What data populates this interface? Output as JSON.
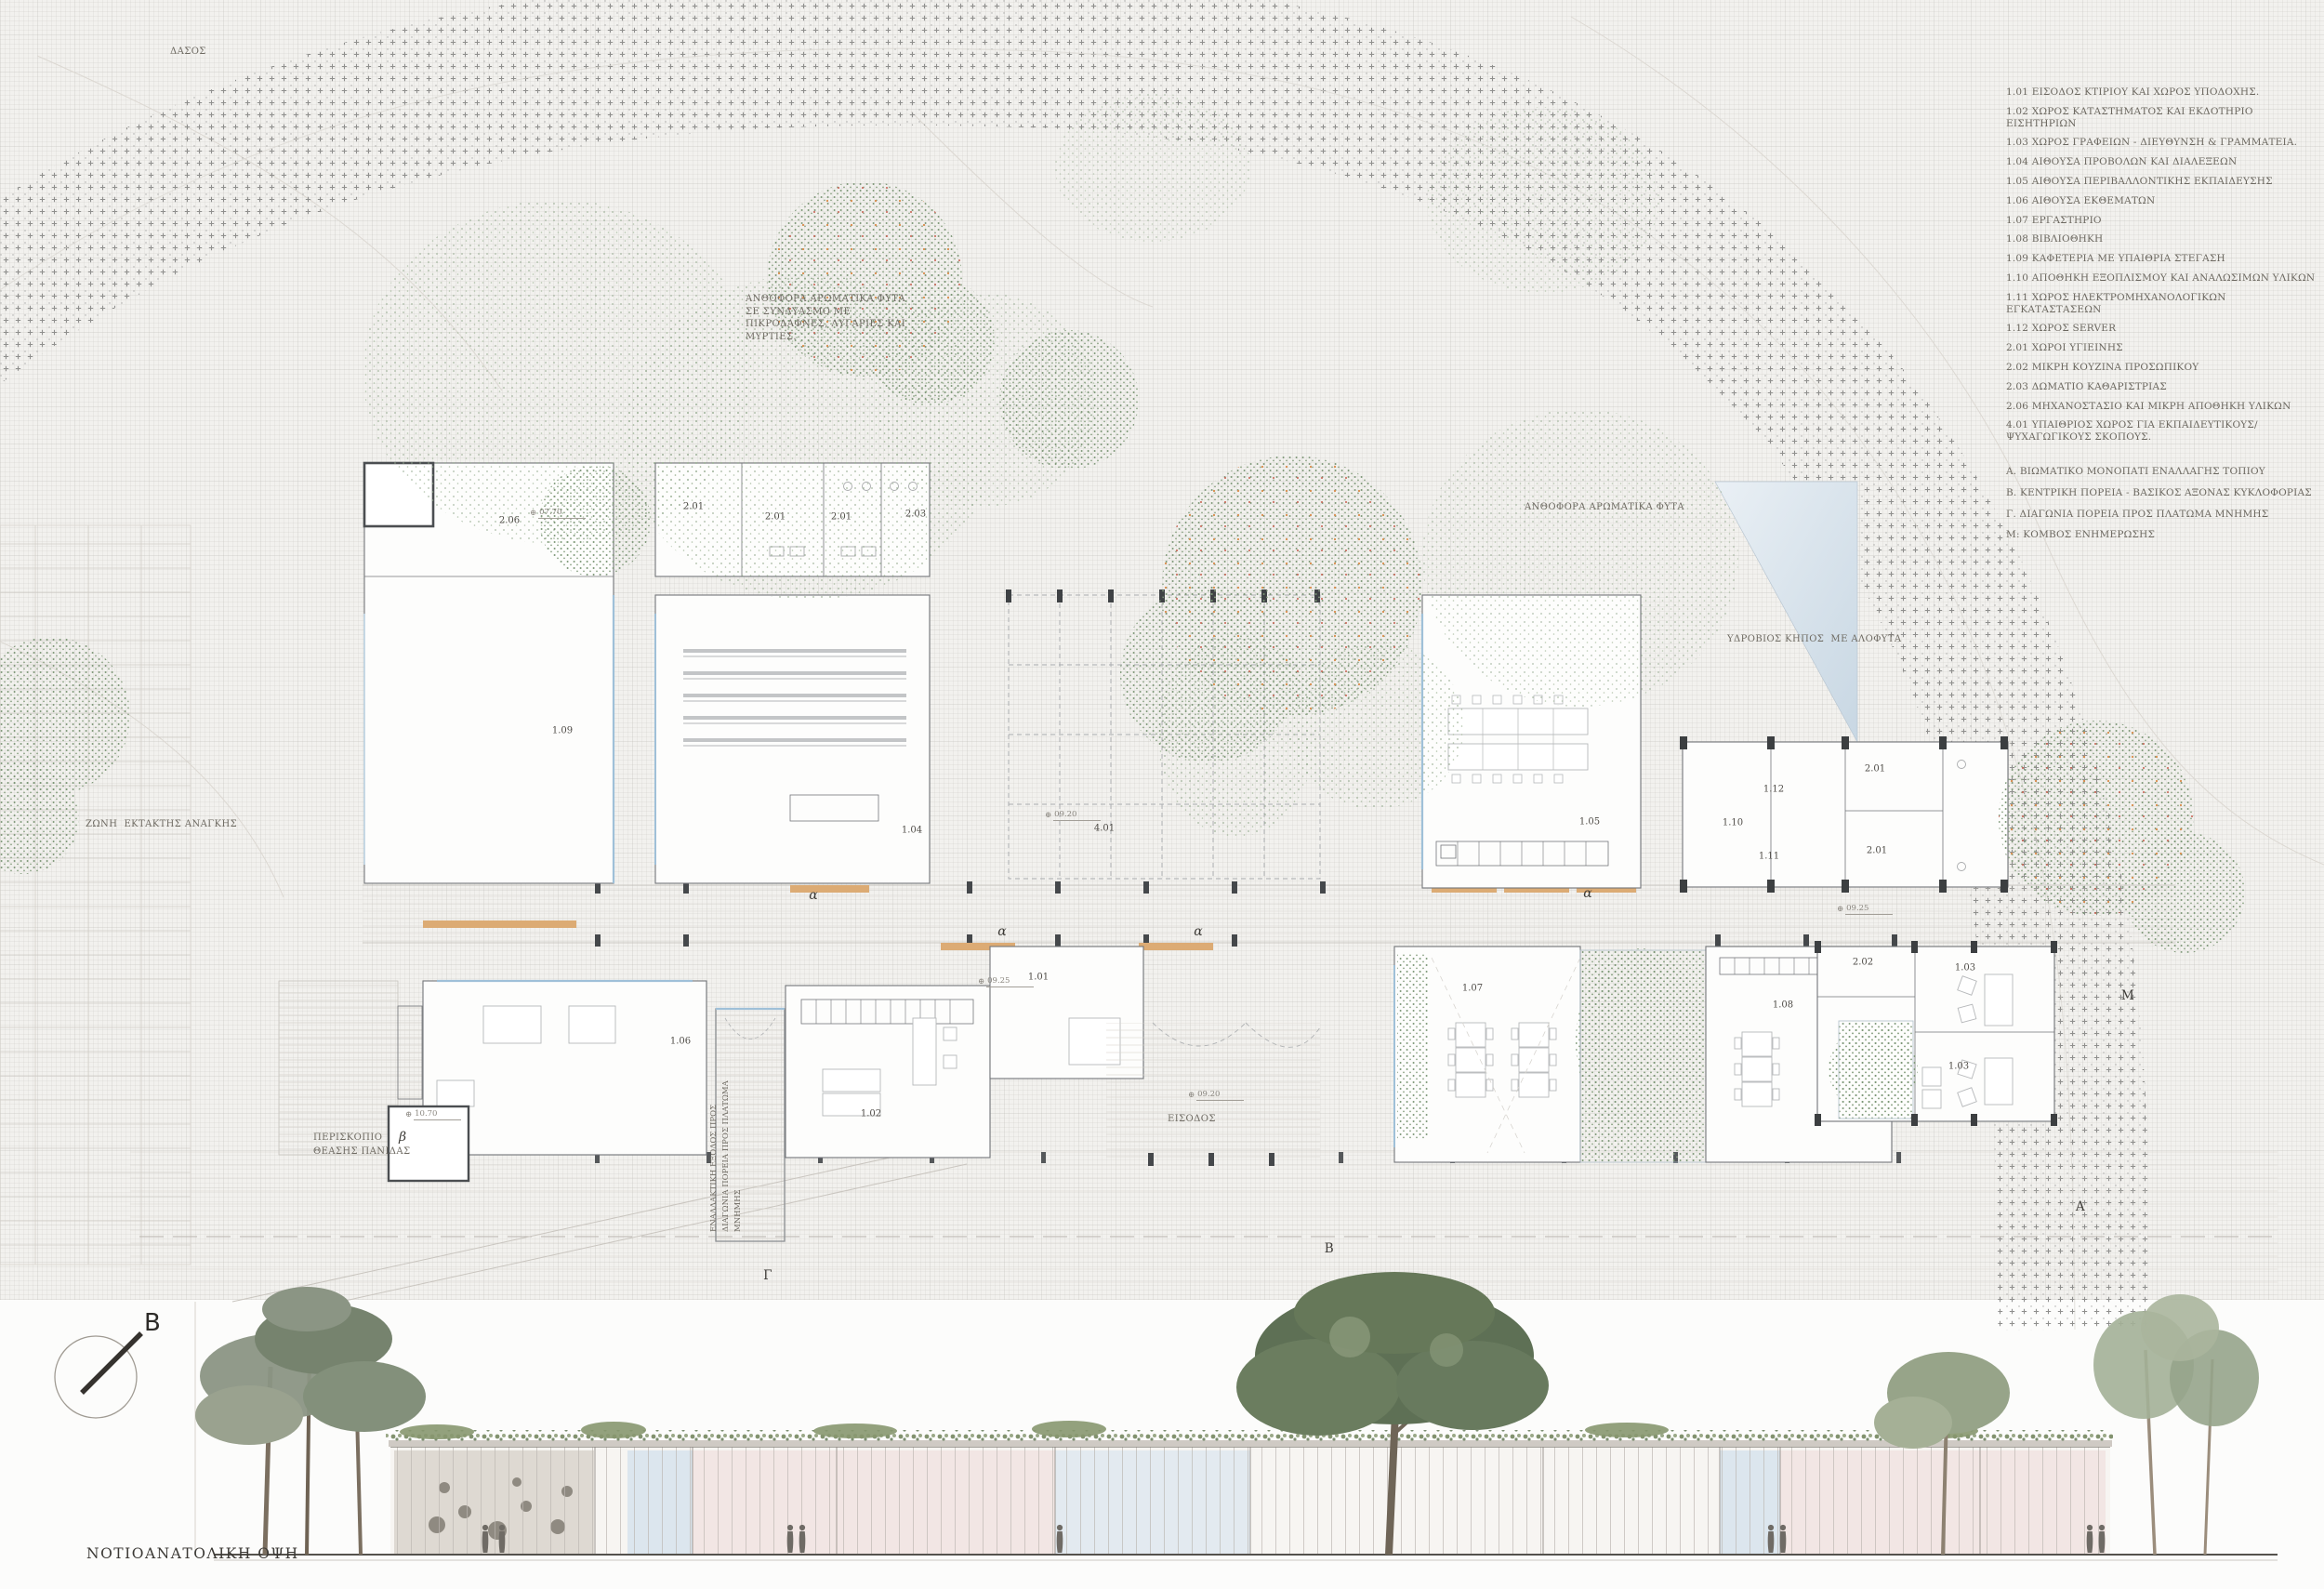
{
  "legend": {
    "items": [
      "1.01 ΕΙΣΟΔΟΣ ΚΤΙΡΙΟΥ ΚΑΙ ΧΩΡΟΣ ΥΠΟΔΟΧΗΣ.",
      "1.02 ΧΩΡΟΣ ΚΑΤΑΣΤΗΜΑΤΟΣ ΚΑΙ ΕΚΔΟΤΗΡΙΟ ΕΙΣΗΤΗΡΙΩΝ",
      "1.03 ΧΩΡΟΣ ΓΡΑΦΕΙΩΝ - ΔΙΕΥΘΥΝΣΗ & ΓΡΑΜΜΑΤΕΙΑ.",
      "1.04 ΑΙΘΟΥΣΑ ΠΡΟΒΟΛΩΝ ΚΑΙ ΔΙΑΛΕΞΕΩΝ",
      "1.05 ΑΙΘΟΥΣΑ ΠΕΡΙΒΑΛΛΟΝΤΙΚΗΣ ΕΚΠΑΙΔΕΥΣΗΣ",
      "1.06 ΑΙΘΟΥΣΑ ΕΚΘΕΜΑΤΩΝ",
      "1.07 ΕΡΓΑΣΤΗΡΙΟ",
      "1.08 ΒΙΒΛΙΟΘΗΚΗ",
      "1.09 ΚΑΦΕΤΕΡΙΑ ΜΕ ΥΠΑΙΘΡΙΑ ΣΤΕΓΑΣΗ",
      "1.10 ΑΠΟΘΗΚΗ ΕΞΟΠΛΙΣΜΟΥ ΚΑΙ ΑΝΑΛΩΣΙΜΩΝ ΥΛΙΚΩΝ",
      "1.11 ΧΩΡΟΣ ΗΛΕΚΤΡΟΜΗΧΑΝΟΛΟΓΙΚΩΝ ΕΓΚΑΤΑΣΤΑΣΕΩΝ",
      "1.12 ΧΩΡΟΣ SERVER",
      "2.01 ΧΩΡΟΙ ΥΓΙΕΙΝΗΣ",
      "2.02 ΜΙΚΡΗ ΚΟΥΖΙΝΑ ΠΡΟΣΩΠΙΚΟΥ",
      "2.03 ΔΩΜΑΤΙΟ ΚΑΘΑΡΙΣΤΡΙΑΣ",
      "2.06 ΜΗΧΑΝΟΣΤΑΣΙΟ ΚΑΙ ΜΙΚΡΗ ΑΠΟΘΗΚΗ ΥΛΙΚΩΝ",
      "4.01 ΥΠΑΙΘΡΙΟΣ ΧΩΡΟΣ ΓΙΑ ΕΚΠΑΙΔΕΥΤΙΚΟΥΣ/ ΨΥΧΑΓΩΓΙΚΟΥΣ ΣΚΟΠΟΥΣ."
    ],
    "routes": [
      "Α. ΒΙΩΜΑΤΙΚΟ ΜΟΝΟΠΑΤΙ ΕΝΑΛΛΑΓΗΣ ΤΟΠΙΟΥ",
      "Β. ΚΕΝΤΡΙΚΗ ΠΟΡΕΙΑ - ΒΑΣΙΚΟΣ ΑΞΟΝΑΣ ΚΥΚΛΟΦΟΡΙΑΣ",
      "Γ. ΔΙΑΓΩΝΙΑ ΠΟΡΕΙΑ ΠΡΟΣ ΠΛΑΤΩΜΑ ΜΝΗΜΗΣ",
      "Μ: ΚΟΜΒΟΣ ΕΝΗΜΕΡΩΣΗΣ"
    ]
  },
  "plan": {
    "annotations": {
      "forest": "ΔΑΣΟΣ",
      "aromatic_mix": "ΑΝΘΟΦΟΡΑ ΑΡΩΜΑΤΙΚΑ ΦΥΤΑ ΣΕ ΣΥΝΔΥΑΣΜΟ ΜΕ ΠΙΚΡΟΔΑΦΝΕΣ, ΛΥΓΑΡΙΕΣ  ΚΑΙ ΜΥΡΤΙΕΣ.",
      "aromatic": "ΑΝΘΟΦΟΡΑ ΑΡΩΜΑΤΙΚΑ ΦΥΤΑ",
      "hydro_garden": "ΥΔΡΟΒΙΟΣ ΚΗΠΟΣ  ΜΕ ΑΛΟΦΥΤΑ",
      "emergency_zone": "ΖΩΝΗ  ΕΚΤΑΚΤΗΣ ΑΝΑΓΚΗΣ",
      "periscope": "ΠΕΡΙΣΚΟΠΙΟ\nΘΕΑΣΗΣ ΠΑΝΙΔΑΣ",
      "entrance": "ΕΙΣΟΔΟΣ",
      "alt_exit": "ΕΝΑΛΛΑΚΤΙΚΗ ΕΞΟΔΟΣ ΠΡΟΣ\nΔΙΑΓΩΝΙΑ ΠΟΡΕΙΑ  ΠΡΟΣ\nΠΛΑΤΩΜΑ ΜΝΗΜΗΣ"
    },
    "room_labels": [
      "2.06",
      "2.01",
      "2.01",
      "2.01",
      "2.03",
      "1.09",
      "1.04",
      "4.01",
      "1.05",
      "1.10",
      "1.12",
      "1.11",
      "2.01",
      "2.01",
      "2.02",
      "1.03",
      "1.03",
      "1.06",
      "1.02",
      "1.01",
      "1.07",
      "1.08"
    ],
    "route_markers": [
      "α",
      "α",
      "α",
      "α",
      "β",
      "Γ",
      "Β",
      "Α",
      "Μ"
    ],
    "level_icon": "⊕",
    "level_markers": [
      "07.70",
      "09.20",
      "10.70",
      "09.25",
      "09.20",
      "09.25"
    ]
  },
  "elevation": {
    "caption": "ΝΟΤΙΟΑΝΑΤΟΛΙΚΗ ΟΨΗ",
    "north_label": "B"
  },
  "colors": {
    "paper": "#f2f1ee",
    "water": "#d7e2ec",
    "foliage": "#9fb59a",
    "wood_accent": "#dcab74",
    "glazing": "#a5c3da",
    "ink": "#5f5c57"
  }
}
